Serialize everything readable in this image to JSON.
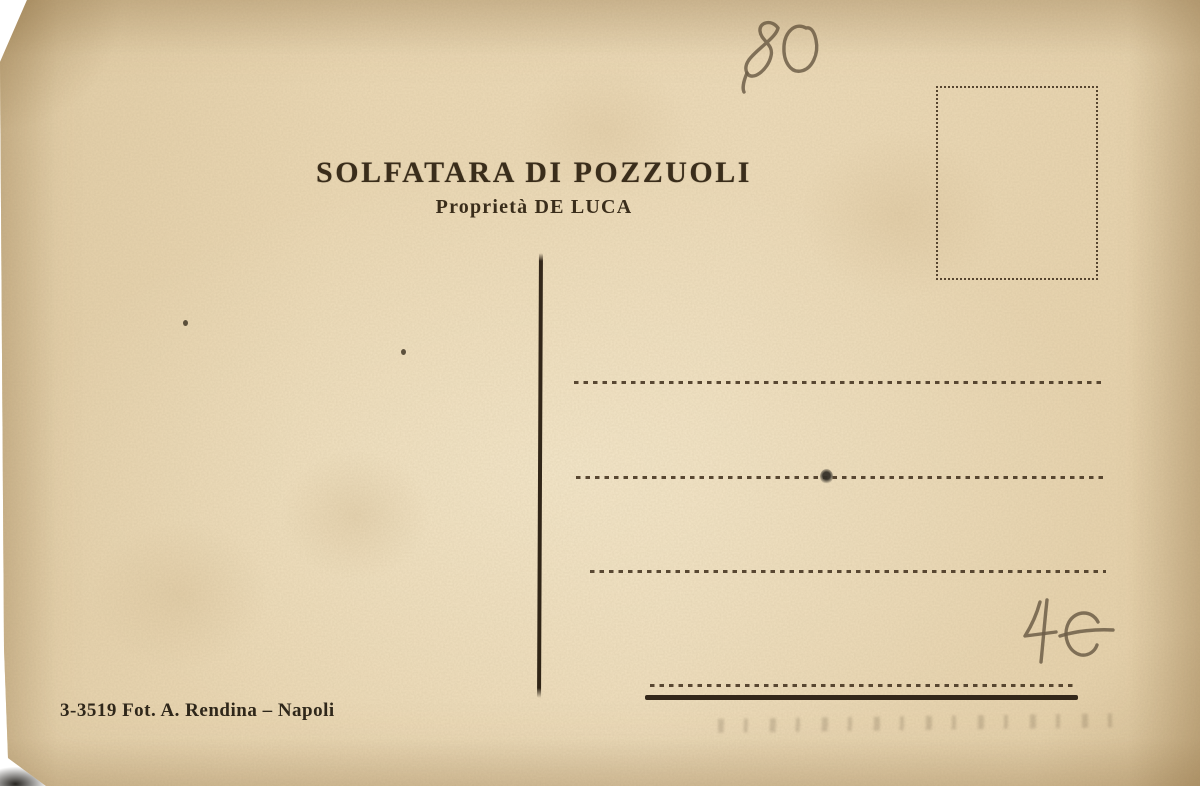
{
  "card": {
    "header": {
      "title": "SOLFATARA DI POZZUOLI",
      "subtitle": "Proprietà DE LUCA"
    },
    "footer": {
      "credit": "3-3519 Fot. A. Rendina – Napoli"
    },
    "handwriting": {
      "top_number": "80",
      "price": "4€"
    },
    "address_section": {
      "dotted_line_count": 4,
      "bottom_rule": "solid"
    },
    "stamp_box": {
      "style": "dotted-outline"
    },
    "colors": {
      "paper": "#e9d6b2",
      "ink": "#3a2d1b",
      "line": "#4b3a26",
      "pencil": "#6d5e48",
      "background": "#ffffff"
    }
  }
}
